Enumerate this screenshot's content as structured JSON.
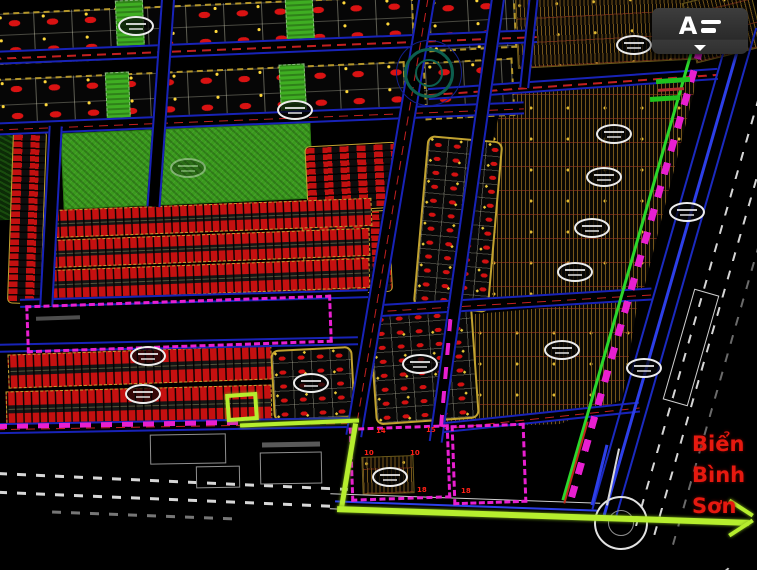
{
  "app": {
    "overflow_button": {
      "logo_glyph": "A",
      "tooltip": "menu"
    }
  },
  "annotation": {
    "line1": "Biển",
    "line2": "Bình",
    "line3": "Sơn",
    "color": "#e6190f"
  },
  "palette": {
    "background": "#000000",
    "parcel_red": "#d31111",
    "park_green": "#3a9a1d",
    "route_chartreuse": "#b6ee2e",
    "boundary_magenta": "#e81fd0",
    "road_blue": "#1823b8",
    "hatch_brown": "#74551a",
    "border_yellow": "#c2a330",
    "corridor_green": "#2bd82b"
  },
  "plot_labels": [
    {
      "t": "14",
      "x": 376,
      "y": 428
    },
    {
      "t": "15",
      "x": 426,
      "y": 427
    },
    {
      "t": "10",
      "x": 364,
      "y": 450
    },
    {
      "t": "10",
      "x": 410,
      "y": 450
    },
    {
      "t": "18",
      "x": 417,
      "y": 487
    },
    {
      "t": "18",
      "x": 461,
      "y": 488
    }
  ],
  "map": {
    "elements": [
      {
        "k": "hatch",
        "n": "brown-zone-top",
        "x": 516,
        "y": -6,
        "w": 186,
        "h": 70,
        "r": -3
      },
      {
        "k": "hatch",
        "n": "brown-zone-corner",
        "x": 688,
        "y": -6,
        "w": 70,
        "h": 62,
        "r": -14
      },
      {
        "k": "hatch",
        "n": "brown-zone-upper",
        "x": 452,
        "y": 70,
        "w": 250,
        "h": 242,
        "clip": "polygon(53px 20px,245px 10px,189px 230px,0px 242px)"
      },
      {
        "k": "hatch",
        "n": "brown-zone-lower",
        "x": 438,
        "y": 295,
        "w": 205,
        "h": 135,
        "clip": "polygon(14px 21px,200px 5px,184px 105px,122px 129px,2px 133px)"
      },
      {
        "k": "hatch",
        "n": "hatch-block-small",
        "x": 362,
        "y": 456,
        "w": 52,
        "h": 38,
        "r": -2
      },
      {
        "k": "dotblock",
        "n": "parcel-row",
        "x": -6,
        "y": 4,
        "w": 420,
        "h": 52,
        "r": -2.5
      },
      {
        "k": "dotblock",
        "n": "parcel-row",
        "x": 428,
        "y": -4,
        "w": 88,
        "h": 54,
        "r": -3
      },
      {
        "k": "dotblock",
        "n": "parcel-row",
        "x": -4,
        "y": 70,
        "w": 410,
        "h": 56,
        "r": -2.5
      },
      {
        "k": "dotblock",
        "n": "parcel-row",
        "x": 424,
        "y": 60,
        "w": 90,
        "h": 58,
        "r": -3
      },
      {
        "k": "darkgreen",
        "n": "vegetation",
        "x": -6,
        "y": 128,
        "w": 22,
        "h": 92,
        "r": -2
      },
      {
        "k": "park",
        "n": "park",
        "x": 62,
        "y": 128,
        "w": 250,
        "h": 76,
        "r": -2.5
      },
      {
        "k": "greenstrip",
        "n": "green-strip",
        "x": 116,
        "y": 0,
        "w": 28,
        "h": 54,
        "r": -2.5
      },
      {
        "k": "greenstrip",
        "n": "green-strip",
        "x": 286,
        "y": -6,
        "w": 28,
        "h": 58,
        "r": -3
      },
      {
        "k": "greenstrip",
        "n": "green-strip",
        "x": 106,
        "y": 72,
        "w": 24,
        "h": 54,
        "r": -2.5
      },
      {
        "k": "greenstrip",
        "n": "green-strip",
        "x": 280,
        "y": 64,
        "w": 26,
        "h": 58,
        "r": -3
      },
      {
        "k": "stripcol",
        "n": "row-housing-block",
        "x": 10,
        "y": 130,
        "w": 34,
        "h": 174,
        "r": 2
      },
      {
        "k": "stripcol",
        "n": "row-housing-block",
        "x": 306,
        "y": 144,
        "w": 92,
        "h": 66,
        "r": -3
      },
      {
        "k": "stripcol",
        "n": "row-housing-block",
        "x": 303,
        "y": 212,
        "w": 88,
        "h": 82,
        "r": -3
      },
      {
        "k": "dotblock2",
        "n": "parcel-block",
        "x": 420,
        "y": 138,
        "w": 76,
        "h": 172,
        "r": 5
      },
      {
        "k": "striprow",
        "n": "townhouse-row",
        "x": 50,
        "y": 204,
        "w": 322,
        "h": 28,
        "r": -2.2
      },
      {
        "k": "striprow",
        "n": "townhouse-row",
        "x": 48,
        "y": 234,
        "w": 322,
        "h": 28,
        "r": -2.2
      },
      {
        "k": "striprow",
        "n": "townhouse-row",
        "x": 48,
        "y": 264,
        "w": 322,
        "h": 30,
        "r": -2.2
      },
      {
        "k": "striprow",
        "n": "townhouse-row",
        "x": 8,
        "y": 350,
        "w": 264,
        "h": 34,
        "r": -2
      },
      {
        "k": "striprow",
        "n": "townhouse-row",
        "x": 6,
        "y": 388,
        "w": 266,
        "h": 36,
        "r": -1.5
      },
      {
        "k": "dotblock2",
        "n": "parcel-block",
        "x": 272,
        "y": 348,
        "w": 82,
        "h": 72,
        "r": -3
      },
      {
        "k": "dotblock2",
        "n": "parcel-block",
        "x": 372,
        "y": 308,
        "w": 104,
        "h": 114,
        "r": -4
      },
      {
        "k": "roadh",
        "n": "road",
        "x": -8,
        "y": 40,
        "w": 545,
        "h": 14,
        "r": -2.3,
        "cl": 1
      },
      {
        "k": "roadh",
        "n": "road",
        "x": -6,
        "y": 112,
        "w": 530,
        "h": 13,
        "r": -2.3,
        "cl": 1
      },
      {
        "k": "roadh",
        "n": "road",
        "x": 20,
        "y": 294,
        "w": 348,
        "h": 9,
        "r": -1.6
      },
      {
        "k": "roadh",
        "n": "road",
        "x": -4,
        "y": 340,
        "w": 362,
        "h": 9,
        "r": -1.2
      },
      {
        "k": "roadh",
        "n": "road",
        "x": -4,
        "y": 420,
        "w": 360,
        "h": 11,
        "r": -1,
        "cl": 1
      },
      {
        "k": "roadh",
        "n": "road",
        "x": 428,
        "y": 78,
        "w": 290,
        "h": 12,
        "r": -4,
        "cl": 1
      },
      {
        "k": "roadh",
        "n": "road",
        "x": 372,
        "y": 296,
        "w": 280,
        "h": 13,
        "r": -3.5,
        "cl": 1
      },
      {
        "k": "roadh",
        "n": "road",
        "x": 440,
        "y": 412,
        "w": 200,
        "h": 11,
        "r": -6,
        "cl": 1
      },
      {
        "k": "roadv",
        "n": "road",
        "x": 44,
        "y": 126,
        "w": 14,
        "h": 180,
        "r": 3
      },
      {
        "k": "roadv",
        "n": "road",
        "x": 154,
        "y": -8,
        "w": 14,
        "h": 215,
        "r": 4
      },
      {
        "k": "roadv",
        "n": "road",
        "x": 382,
        "y": -6,
        "w": 17,
        "h": 445,
        "r": 9.5,
        "cl": 1
      },
      {
        "k": "roadv",
        "n": "road",
        "x": 460,
        "y": -6,
        "w": 14,
        "h": 450,
        "r": 8
      },
      {
        "k": "roadv",
        "n": "road",
        "x": 524,
        "y": -4,
        "w": 10,
        "h": 92,
        "r": 6
      },
      {
        "k": "roadw",
        "n": "roundabout-approach-road",
        "x": 330,
        "y": 498,
        "w": 270,
        "h": 16,
        "r": 2
      },
      {
        "k": "line",
        "n": "road-blue-line",
        "x": 335,
        "y": 505,
        "w": 262,
        "h": 2,
        "r": 2,
        "c": "#2d3fe8"
      },
      {
        "k": "line",
        "n": "corridor-green-line",
        "x": 631,
        "y": 5,
        "w": 3,
        "h": 505,
        "r": 16,
        "c": "#2bd82b"
      },
      {
        "k": "mlinev",
        "n": "corridor-magenta-boundary",
        "x": 637,
        "y": 7,
        "w": 7,
        "h": 500,
        "r": 16
      },
      {
        "k": "line",
        "n": "corridor-blue-line",
        "x": 661,
        "y": 14,
        "w": 2,
        "h": 505,
        "r": 16,
        "c": "#1b2ac0"
      },
      {
        "k": "line",
        "n": "corridor-blue-line",
        "x": 673,
        "y": 15,
        "w": 3,
        "h": 510,
        "r": 16,
        "c": "#2d3fe8"
      },
      {
        "k": "line",
        "n": "corridor-blue-line",
        "x": 685,
        "y": 18,
        "w": 2,
        "h": 510,
        "r": 16,
        "c": "#1b2ac0"
      },
      {
        "k": "wdash",
        "n": "corridor-white-dashed",
        "x": 706,
        "y": 21,
        "w": 2,
        "h": 515,
        "r": 16
      },
      {
        "k": "wdash",
        "n": "corridor-white-dashed",
        "x": 725,
        "y": 25,
        "w": 2,
        "h": 520,
        "r": 16
      },
      {
        "k": "wdash",
        "n": "corridor-white-dashed",
        "x": 745,
        "y": 25,
        "w": 2,
        "h": 530,
        "r": 16,
        "o": 0.5
      },
      {
        "k": "bld",
        "n": "corridor-strip-outline",
        "x": 678,
        "y": 290,
        "w": 26,
        "h": 115,
        "r": 16,
        "c": "#d0d0d0"
      },
      {
        "k": "circle",
        "n": "roundabout",
        "x": 594,
        "y": 496,
        "w": 54,
        "h": 54,
        "c": "#e2e2e2",
        "b": 2.5
      },
      {
        "k": "circle",
        "n": "roundabout-inner",
        "x": 608,
        "y": 510,
        "w": 26,
        "h": 26,
        "c": "#8f8f8f",
        "b": 1.5
      },
      {
        "k": "line",
        "n": "approach-line",
        "x": 612,
        "y": 448,
        "w": 2,
        "h": 58,
        "r": 12,
        "c": "#d8d8d8"
      },
      {
        "k": "line",
        "n": "approach-line",
        "x": 598,
        "y": 444,
        "w": 3,
        "h": 62,
        "r": 14,
        "c": "#2d3fe8"
      },
      {
        "k": "line",
        "n": "approach-line",
        "x": 575,
        "y": 420,
        "w": 2,
        "h": 85,
        "r": 16,
        "c": "#c22a1a"
      },
      {
        "k": "curve",
        "n": "roundabout-exit-curve",
        "x": 545,
        "y": 534,
        "w": 95,
        "h": 52,
        "r": 6
      },
      {
        "k": "curve",
        "n": "roundabout-exit-curve",
        "x": 638,
        "y": 530,
        "w": 100,
        "h": 55,
        "r": -8
      },
      {
        "k": "circle",
        "n": "intersection-ring",
        "x": 396,
        "y": 40,
        "w": 66,
        "h": 66,
        "c": "#141f8a",
        "b": 1.5
      },
      {
        "k": "circle",
        "n": "intersection-ring",
        "x": 404,
        "y": 48,
        "w": 50,
        "h": 50,
        "c": "#0d5f4e",
        "b": 3
      },
      {
        "k": "circle",
        "n": "intersection-ring",
        "x": 415,
        "y": 59,
        "w": 28,
        "h": 28,
        "c": "#0d5f4e",
        "b": 2
      },
      {
        "k": "mrect",
        "n": "planning-boundary",
        "x": 26,
        "y": 300,
        "w": 306,
        "h": 48,
        "r": -2
      },
      {
        "k": "mline",
        "n": "planning-boundary-line",
        "x": -4,
        "y": 422,
        "w": 242,
        "h": 5,
        "r": -1
      },
      {
        "k": "mrect",
        "n": "planning-boundary",
        "x": 350,
        "y": 426,
        "w": 100,
        "h": 74,
        "r": -2
      },
      {
        "k": "mrect",
        "n": "planning-boundary",
        "x": 452,
        "y": 424,
        "w": 74,
        "h": 80,
        "r": -2
      },
      {
        "k": "mlinev",
        "n": "planning-boundary-line",
        "x": 444,
        "y": 312,
        "w": 4,
        "h": 115,
        "r": 5
      },
      {
        "k": "wdashh",
        "n": "existing-road-dashed",
        "x": -2,
        "y": 480,
        "w": 350,
        "h": 3,
        "r": 2.6
      },
      {
        "k": "wdashh",
        "n": "existing-road-dashed",
        "x": -2,
        "y": 498,
        "w": 345,
        "h": 3,
        "r": 2.4
      },
      {
        "k": "wdashh",
        "n": "existing-road-dashed",
        "x": 52,
        "y": 514,
        "w": 185,
        "h": 3,
        "r": 2.2,
        "o": 0.55
      },
      {
        "k": "bld",
        "n": "building-outline",
        "x": 150,
        "y": 434,
        "w": 76,
        "h": 30,
        "r": -1
      },
      {
        "k": "bld",
        "n": "building-outline",
        "x": 260,
        "y": 452,
        "w": 62,
        "h": 32,
        "r": -1
      },
      {
        "k": "bld",
        "n": "building-outline",
        "x": 196,
        "y": 466,
        "w": 44,
        "h": 22,
        "r": -1
      },
      {
        "k": "bar",
        "n": "street-name-text",
        "x": 656,
        "y": 78,
        "w": 34,
        "h": 5,
        "r": -4,
        "c": "#1ec21e"
      },
      {
        "k": "bar",
        "n": "street-name-text",
        "x": 650,
        "y": 96,
        "w": 30,
        "h": 5,
        "r": -4,
        "c": "#1ec21e"
      },
      {
        "k": "bar",
        "n": "small-red-text",
        "x": 658,
        "y": 88,
        "w": 26,
        "h": 3,
        "r": -4,
        "c": "#b03030"
      },
      {
        "k": "bar",
        "n": "small-label",
        "x": 262,
        "y": 442,
        "w": 58,
        "h": 5,
        "r": -1,
        "c": "rgba(255,255,255,0.35)"
      },
      {
        "k": "bar",
        "n": "small-label",
        "x": 36,
        "y": 316,
        "w": 44,
        "h": 4,
        "r": -2,
        "c": "rgba(255,255,255,0.3)"
      },
      {
        "k": "rrect",
        "n": "highlighted-plot",
        "x": 226,
        "y": 393,
        "w": 32,
        "h": 28,
        "r": -4
      },
      {
        "k": "route",
        "n": "route-segment",
        "x": 240,
        "y": 421,
        "w": 119,
        "h": 4,
        "r": -2.4
      },
      {
        "k": "route",
        "n": "route-segment",
        "x": 346,
        "y": 423,
        "w": 5,
        "h": 86,
        "r": 9.5
      },
      {
        "k": "route",
        "n": "route-segment",
        "x": 337,
        "y": 513,
        "w": 412,
        "h": 6,
        "r": 1.9
      },
      {
        "k": "route",
        "n": "route-arrowhead",
        "x": 727,
        "y": 506,
        "w": 28,
        "h": 4,
        "r": 33
      },
      {
        "k": "route",
        "n": "route-arrowhead",
        "x": 727,
        "y": 526,
        "w": 28,
        "h": 4,
        "r": -33
      },
      {
        "k": "stamp",
        "n": "plot-stamp",
        "x": 118,
        "y": 16
      },
      {
        "k": "stamp",
        "n": "plot-stamp",
        "x": 277,
        "y": 100
      },
      {
        "k": "stamp",
        "n": "plot-stamp",
        "x": 170,
        "y": 158,
        "o": 0.4
      },
      {
        "k": "stamp",
        "n": "plot-stamp",
        "x": 130,
        "y": 346
      },
      {
        "k": "stamp",
        "n": "plot-stamp",
        "x": 125,
        "y": 384
      },
      {
        "k": "stamp",
        "n": "plot-stamp",
        "x": 293,
        "y": 373
      },
      {
        "k": "stamp",
        "n": "plot-stamp",
        "x": 402,
        "y": 354
      },
      {
        "k": "stamp",
        "n": "plot-stamp",
        "x": 372,
        "y": 467
      },
      {
        "k": "stamp",
        "n": "plot-stamp",
        "x": 616,
        "y": 35
      },
      {
        "k": "stamp",
        "n": "plot-stamp",
        "x": 596,
        "y": 124
      },
      {
        "k": "stamp",
        "n": "plot-stamp",
        "x": 586,
        "y": 167
      },
      {
        "k": "stamp",
        "n": "plot-stamp",
        "x": 574,
        "y": 218
      },
      {
        "k": "stamp",
        "n": "plot-stamp",
        "x": 557,
        "y": 262
      },
      {
        "k": "stamp",
        "n": "plot-stamp",
        "x": 544,
        "y": 340
      },
      {
        "k": "stamp",
        "n": "plot-stamp",
        "x": 626,
        "y": 358
      },
      {
        "k": "stamp",
        "n": "plot-stamp",
        "x": 669,
        "y": 202
      }
    ]
  }
}
